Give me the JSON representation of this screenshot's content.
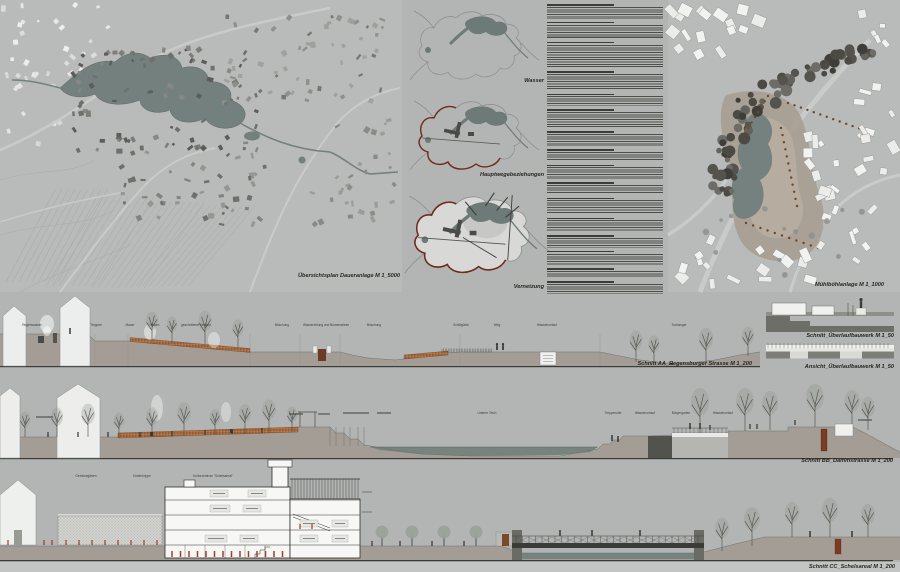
{
  "labels": {
    "map_main": "Übersichtsplan Daueranlage M 1_5000",
    "diagram_wasser": "Wasser",
    "diagram_wege": "Hauptwegebeziehungen",
    "diagram_vernetzung": "Vernetzung",
    "map_detail": "Mühlböhlanlage M 1_1000",
    "section_aa": "Schnitt AA_Regensburger Strasse M 1_200",
    "schnitt_ueberlauf": "Schnitt_Überlaufbauwerk M 1_50",
    "ansicht_ueberlauf": "Ansicht_Überlaufbauwerk M 1_50",
    "section_bb": "Schnitt BB_Dammstrasse M 1_200",
    "section_cc": "Schnitt CC_Schelsareal M 1_200"
  },
  "annotations": {
    "aa": [
      "Regenwasser",
      "Treppen",
      "Mauer",
      "Hecken",
      "geschnittene Hecken",
      "Böschung",
      "Wasserleitung und Blumenwiese",
      "Böschung",
      "Schilfgürtel",
      "Weg",
      "Wasserumlauf",
      "Tuchanger"
    ],
    "bb": [
      "Unterer Teich",
      "Treppenufer",
      "Wasserumlauf",
      "Bürgergarten",
      "Wasserumlauf"
    ],
    "cc": [
      "Gemüsegärten",
      "Kinderkrippe",
      "Kulturzentrum \"Schelsareal\""
    ]
  },
  "text_column": {
    "paragraphs": [
      {
        "lines": 5
      },
      {
        "lines": 6
      },
      {
        "lines": 10
      },
      {
        "lines": 7
      },
      {
        "lines": 4
      },
      {
        "lines": 7
      },
      {
        "lines": 5
      },
      {
        "lines": 4
      },
      {
        "lines": 5
      },
      {
        "lines": 4
      },
      {
        "lines": 6
      },
      {
        "lines": 5
      },
      {
        "lines": 4
      },
      {
        "lines": 5
      },
      {
        "lines": 3
      },
      {
        "lines": 4
      }
    ]
  },
  "colors": {
    "board_bg": "#b3b5b4",
    "panel_bg": "#b9bbba",
    "water": "#76837f",
    "water_dark": "#6d7a78",
    "ground": "#a39d96",
    "hedge": "#a96b3f",
    "accent_red": "#6e2a1c",
    "rust": "#7b3a22",
    "figure_red": "#a23526",
    "ink": "#26261f",
    "white_building": "#f0f0ee"
  }
}
